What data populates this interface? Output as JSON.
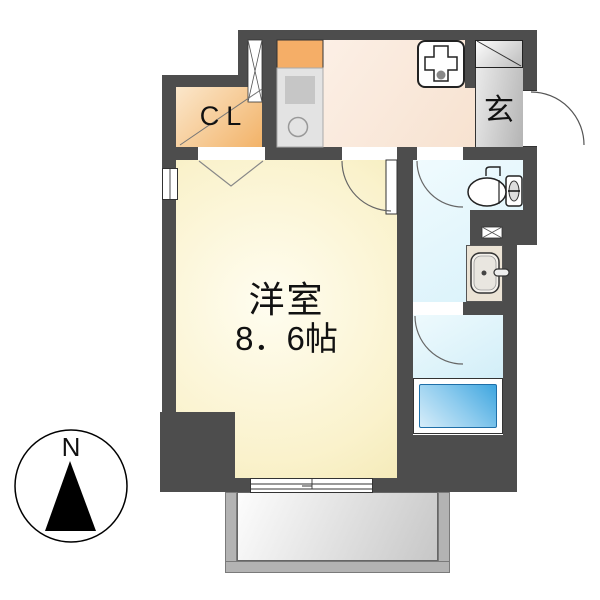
{
  "plan_type": "apartment-floor-plan",
  "rooms": {
    "closet": {
      "label": "CL"
    },
    "entrance": {
      "label": "玄"
    },
    "main_room": {
      "name": "洋室",
      "area": "8．6帖"
    }
  },
  "compass": {
    "north": "N"
  },
  "icons": {
    "kitchen": "kitchen-counter-icon",
    "laundry": "washing-machine-pan-icon",
    "toilet": "toilet-icon",
    "washbasin": "washbasin-icon",
    "bath": "bathtub-icon",
    "compass": "compass-north-icon"
  },
  "colors": {
    "wall": "#4d4d4d",
    "main_room_fill": "#faf2cc",
    "kitchen_fill": "#f9e9db",
    "closet_fill": "#f2b165",
    "entrance_fill": "#c6c6c6",
    "wet_area_fill": "#ddf3fa",
    "bathtub_fill": "#3fa6df",
    "washbasin_fill": "#ebe3d5",
    "balcony_fill": "#b3b3b3"
  }
}
